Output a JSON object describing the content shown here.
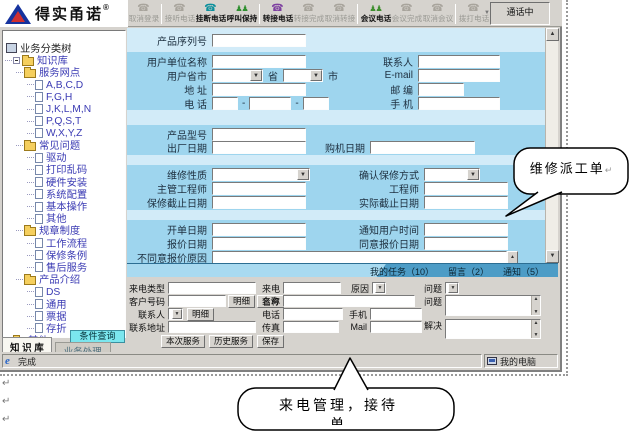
{
  "logo": {
    "brand": "得实甬诺",
    "reg": "®"
  },
  "toolbar": {
    "status": "通话中",
    "buttons": [
      {
        "label": "取消登录",
        "icon": "agent-logout-icon",
        "enabled": false,
        "sep": true
      },
      {
        "label": "接听电话",
        "icon": "answer-call-icon",
        "enabled": false
      },
      {
        "label": "挂断电话",
        "icon": "hangup-call-icon",
        "enabled": true
      },
      {
        "label": "呼叫保持",
        "icon": "hold-call-icon",
        "enabled": true,
        "sep": true
      },
      {
        "label": "转接电话",
        "icon": "transfer-call-icon",
        "enabled": true
      },
      {
        "label": "转接完成",
        "icon": "transfer-done-icon",
        "enabled": false
      },
      {
        "label": "取消转接",
        "icon": "cancel-transfer-icon",
        "enabled": false,
        "sep": true
      },
      {
        "label": "会议电话",
        "icon": "conference-call-icon",
        "enabled": true
      },
      {
        "label": "会议完成",
        "icon": "conference-done-icon",
        "enabled": false
      },
      {
        "label": "取消会议",
        "icon": "cancel-conference-icon",
        "enabled": false,
        "sep": true
      },
      {
        "label": "拨打电话",
        "icon": "dial-call-icon",
        "enabled": false,
        "dropdown": true
      }
    ]
  },
  "tree": {
    "root": "业务分类树",
    "items": [
      {
        "level": 1,
        "type": "folder",
        "exp": true,
        "label": "知识库"
      },
      {
        "level": 2,
        "type": "folder",
        "label": "服务网点"
      },
      {
        "level": 3,
        "type": "page",
        "label": "A,B,C,D"
      },
      {
        "level": 3,
        "type": "page",
        "label": "F,G,H"
      },
      {
        "level": 3,
        "type": "page",
        "label": "J,K,L,M,N"
      },
      {
        "level": 3,
        "type": "page",
        "label": "P,Q,S,T"
      },
      {
        "level": 3,
        "type": "page",
        "label": "W,X,Y,Z"
      },
      {
        "level": 2,
        "type": "folder",
        "label": "常见问题"
      },
      {
        "level": 3,
        "type": "page",
        "label": "驱动"
      },
      {
        "level": 3,
        "type": "page",
        "label": "打印乱码"
      },
      {
        "level": 3,
        "type": "page",
        "label": "硬件安装"
      },
      {
        "level": 3,
        "type": "page",
        "label": "系统配置"
      },
      {
        "level": 3,
        "type": "page",
        "label": "基本操作"
      },
      {
        "level": 3,
        "type": "page",
        "label": "其他"
      },
      {
        "level": 2,
        "type": "folder",
        "label": "规章制度"
      },
      {
        "level": 3,
        "type": "page",
        "label": "工作流程"
      },
      {
        "level": 3,
        "type": "page",
        "label": "保修条例"
      },
      {
        "level": 3,
        "type": "page",
        "label": "售后服务"
      },
      {
        "level": 2,
        "type": "folder",
        "label": "产品介绍"
      },
      {
        "level": 3,
        "type": "page",
        "label": "DS"
      },
      {
        "level": 3,
        "type": "page",
        "label": "通用"
      },
      {
        "level": 3,
        "type": "page",
        "label": "票据"
      },
      {
        "level": 3,
        "type": "page",
        "label": "存折"
      },
      {
        "level": 1,
        "type": "folder-closed",
        "label": "其他"
      }
    ]
  },
  "left_panel": {
    "query_button": "条件查询",
    "tabs": [
      {
        "label": "知 识 库",
        "active": true
      },
      {
        "label": "业务处理",
        "active": false
      }
    ]
  },
  "main_form": {
    "serial": "产品序列号",
    "unit": "用户单位名称",
    "province_city": "用户省市",
    "province_suffix": "省",
    "city_suffix": "市",
    "address": "地 址",
    "phone": "电 话",
    "contact": "联系人",
    "email": "E-mail",
    "zip": "邮 编",
    "mobile": "手 机",
    "model": "产品型号",
    "factory_date": "出厂日期",
    "purchase_date": "购机日期",
    "repair_nature": "维修性质",
    "warranty_mode": "确认保修方式",
    "chief_engineer": "主管工程师",
    "engineer": "工程师",
    "warranty_deadline": "保修截止日期",
    "actual_deadline": "实际截止日期",
    "open_date": "开单日期",
    "notify_time": "通知用户时间",
    "quote_date": "报价日期",
    "agree_quote_date": "同意报价日期",
    "disagree_reason": "不同意报价原因"
  },
  "task_tabs": [
    {
      "label": "我的任务（10）"
    },
    {
      "label": "留言（2）"
    },
    {
      "label": "通知（5）"
    }
  ],
  "call_form": {
    "call_type": "来电类型",
    "caller": "来电",
    "reason": "原因",
    "issue_combo": "问题",
    "customer_no": "客户号码",
    "name": "名称",
    "contact": "联系人",
    "phone": "电话",
    "mobile": "手机",
    "address": "联系地址",
    "fax": "传真",
    "mail": "Mail",
    "issue": "问题",
    "solution": "解决",
    "detail_button": "明细",
    "query_button": "查询",
    "detail_button2": "明细",
    "this_service": "本次服务",
    "history_service": "历史服务",
    "save": "保存"
  },
  "status_bar": {
    "left": "完成",
    "right": "我的电脑"
  },
  "callouts": {
    "repair_order": "维修派工单",
    "incoming_line1": "来电管理，接待",
    "incoming_line2": "单"
  },
  "misc": {
    "dash": "-",
    "pilcrow": "↵"
  }
}
